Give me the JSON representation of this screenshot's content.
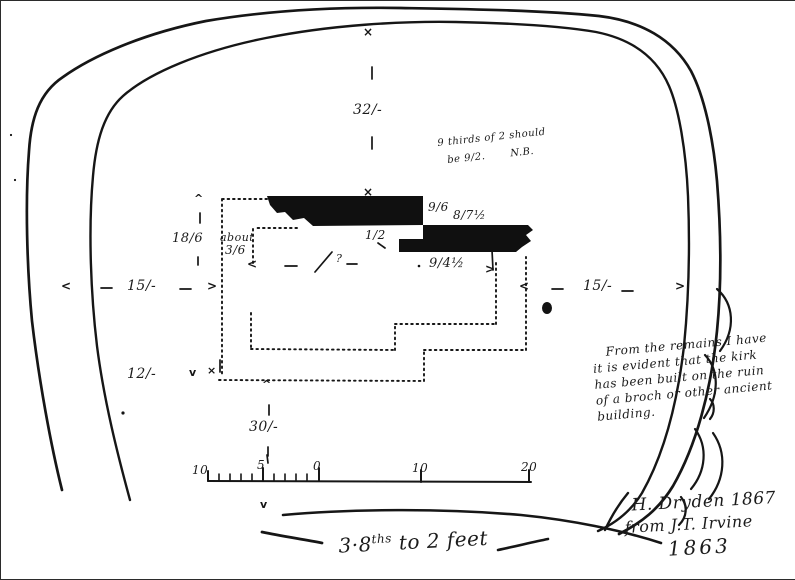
{
  "drawing": {
    "dimensions": {
      "top": "32/-",
      "left_side": "15/-",
      "right_side": "15/-",
      "lower_left": "12/-",
      "bottom": "30/-",
      "west_wall": "18/6",
      "about_label": "about",
      "about_value": "3/6",
      "step": "1/2",
      "north_a": "9/6",
      "north_b": "8/7½",
      "interior": "9/4½",
      "query": "?"
    },
    "memo": {
      "line1": "9 thirds of 2 should",
      "line2": "be 9/2.",
      "nb": "N.B."
    },
    "note": {
      "l1": "From the remains I have",
      "l2": "it is evident that the kirk",
      "l3": "has been built on the ruin",
      "l4": "of a broch or other ancient",
      "l5": "building."
    },
    "signature": {
      "l1": "H. Dryden 1867",
      "l2": "from J.T. Irvine",
      "l3": "1863"
    },
    "scale": {
      "caption_base": "3·8",
      "caption_sup": "ths",
      "caption_rest": " to 2 feet",
      "labels": [
        "10",
        "5",
        "0",
        "10",
        "20"
      ]
    },
    "marks": {
      "up": "^",
      "down": "v",
      "left": "<",
      "right": ">",
      "cross": "×",
      "dot": "·"
    },
    "colors": {
      "ink": "#1b1b1b",
      "paper": "#ffffff"
    }
  }
}
